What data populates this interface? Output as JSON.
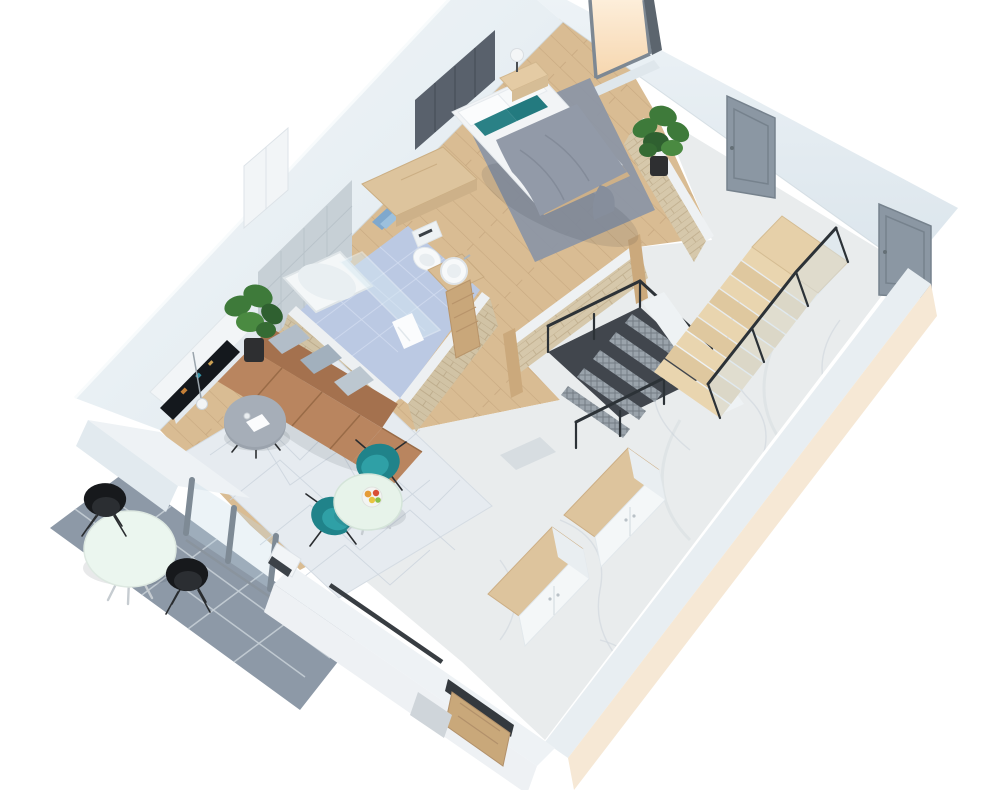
{
  "scene": {
    "title": "3D isometric apartment floor plan render",
    "view": "top-down isometric 3D cutaway, white background",
    "visible_text": "none"
  },
  "palette": {
    "background": "#ffffff",
    "wood_floor": "#d9bc93",
    "wood_plank_line": "#c8a981",
    "marble": "#e9eced",
    "bath_tile": "#b4c3e0",
    "terrace_tile": "#8d99a7",
    "wall_white": "#edf2f5",
    "wall_face": "#e2eaef",
    "exterior_cream": "#f6e8d5",
    "brick": "#d6c8ab",
    "headboard_gray": "#59616c",
    "bath_wall_tile": "#c7d0d6",
    "duvet": "#929aa8",
    "rug_gray": "#8e96a4",
    "rug_light": "#e6ebf0",
    "sofa": "#b9855f",
    "sofa_back": "#a4714e",
    "cushion_gray": "#b2bdc8",
    "teal": "#20838a",
    "dining_table": "#e7f3ea",
    "terrace_table": "#ebf6ef",
    "wood_furniture": "#ddc49d",
    "door_gray": "#8b97a3",
    "entry_wood": "#c9a87a",
    "metal_dark": "#41464d",
    "mesh_gray": "#9aa3ab",
    "window_peach": "#f9ddbb",
    "glass": "#cfe3ee",
    "plant_green": "#3e7a3a",
    "black_chair": "#17191c",
    "towel_blue": "#7fa8cd"
  },
  "rooms": {
    "bedroom": {
      "label": "Bedroom",
      "floor": "oak wood planks",
      "furniture": [
        "double bed with gray duvet",
        "two white pillows",
        "two teal accent pillows",
        "dark upholstered headboard panel",
        "nightstand with white table lamp",
        "gray area rug",
        "wooden dresser",
        "tall white cabinet",
        "fiddle-leaf plant"
      ]
    },
    "bathroom": {
      "label": "Bathroom",
      "floor": "blue ceramic tile",
      "furniture": [
        "bathtub with glass shower screen",
        "white hand towel",
        "toilet",
        "round vessel sink on wood vanity",
        "blue towels on wall rail",
        "sliding wooden door",
        "brick half-walls"
      ]
    },
    "living_room": {
      "label": "Living room",
      "floor": "oak wood planks",
      "furniture": [
        "brown leather sofa with chaise",
        "three gray cushions",
        "white TV console",
        "curved TV",
        "round gray coffee table",
        "pendant lamp",
        "light patterned rug",
        "potted plant"
      ]
    },
    "dining_area": {
      "label": "Dining area",
      "furniture": [
        "round mint table",
        "fruit bowl",
        "two teal shell chairs"
      ]
    },
    "hallway": {
      "label": "Hallway / landing",
      "floor": "white marble",
      "furniture": [
        "wooden staircase up with glass railing",
        "steel mesh staircase down",
        "black balustrade",
        "two gray interior doors",
        "window with warm daylight",
        "brick half-walls with wood door frames"
      ]
    },
    "entry_corridor": {
      "label": "Entry corridor",
      "floor": "white marble",
      "furniture": [
        "white wardrobe row with wood tops",
        "wooden entry door with dark lintel",
        "doormat"
      ]
    },
    "terrace": {
      "label": "Terrace",
      "floor": "gray stone tile",
      "furniture": [
        "round white bistro table",
        "two black chairs",
        "sliding glass doors"
      ]
    }
  }
}
